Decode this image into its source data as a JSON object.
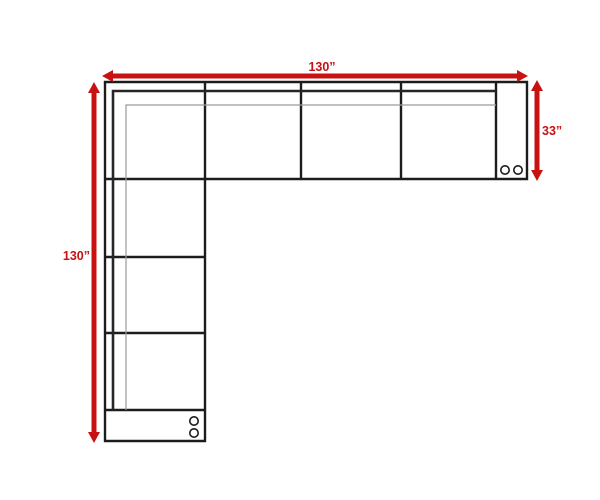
{
  "diagram": {
    "type": "sectional-sofa-dimension-drawing",
    "dimensions": {
      "top": "130”",
      "left": "130”",
      "right": "33”"
    },
    "colors": {
      "arrow": "#c81111",
      "outline": "#1c1c1c",
      "detail_line": "#9a9a9a",
      "background": "#ffffff"
    }
  }
}
